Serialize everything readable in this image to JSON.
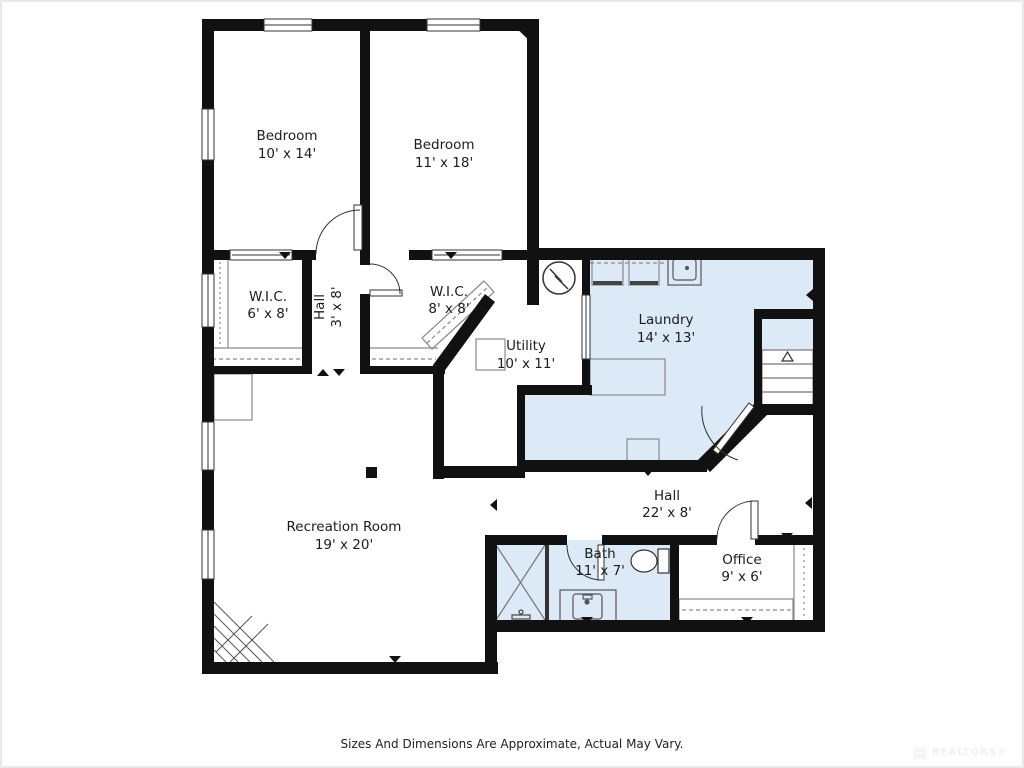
{
  "colors": {
    "wall": "#111111",
    "room_fill": "#dbeaf6",
    "fixture_line": "#8a8a8a",
    "fixture_dark": "#333333",
    "text": "#1c1c1c"
  },
  "rooms": {
    "bedroom1": {
      "name": "Bedroom",
      "dims": "10' x 14'"
    },
    "bedroom2": {
      "name": "Bedroom",
      "dims": "11' x 18'"
    },
    "wic1": {
      "name": "W.I.C.",
      "dims": "6' x 8'"
    },
    "hall1": {
      "name": "Hall",
      "dims": "3' x 8'"
    },
    "wic2": {
      "name": "W.I.C.",
      "dims": "8' x 8'"
    },
    "utility": {
      "name": "Utility",
      "dims": "10' x 11'"
    },
    "laundry": {
      "name": "Laundry",
      "dims": "14' x 13'"
    },
    "rec": {
      "name": "Recreation Room",
      "dims": "19' x 20'"
    },
    "hall2": {
      "name": "Hall",
      "dims": "22' x 8'"
    },
    "bath": {
      "name": "Bath",
      "dims": "11' x 7'"
    },
    "office": {
      "name": "Office",
      "dims": "9' x 6'"
    }
  },
  "footer": "Sizes And Dimensions Are Approximate, Actual May Vary.",
  "watermark": "REALTORS®"
}
